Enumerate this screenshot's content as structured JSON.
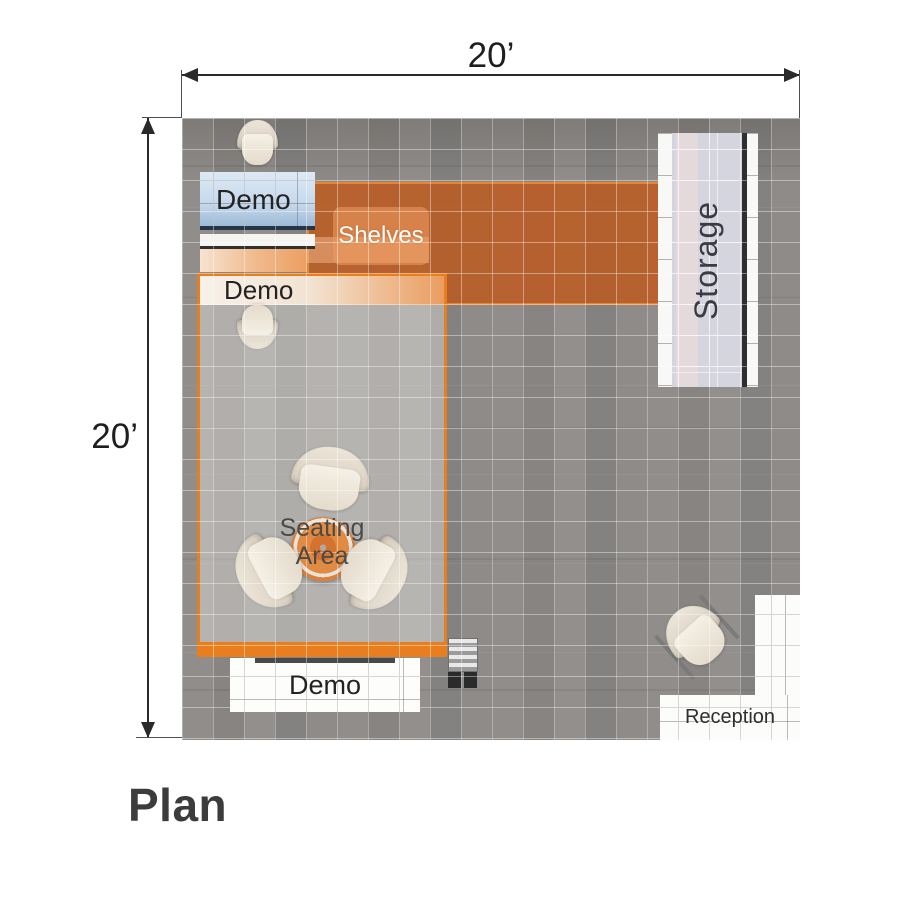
{
  "title": "Plan",
  "dimensions": {
    "width": "20’",
    "height": "20’"
  },
  "labels": {
    "demo_top": "Demo",
    "demo_middle": "Demo",
    "demo_bottom": "Demo",
    "shelves": "Shelves",
    "storage": "Storage",
    "seating_area": "Seating Area",
    "reception": "Reception"
  },
  "colors": {
    "accent_orange": "#e87e1e",
    "overlay_orange": "#c15819",
    "counter_blue": "#c5d8ec",
    "storage_lavender": "#d5d5df",
    "floor_gray": "#8d8a87",
    "text_dark": "#3c3c3c"
  }
}
